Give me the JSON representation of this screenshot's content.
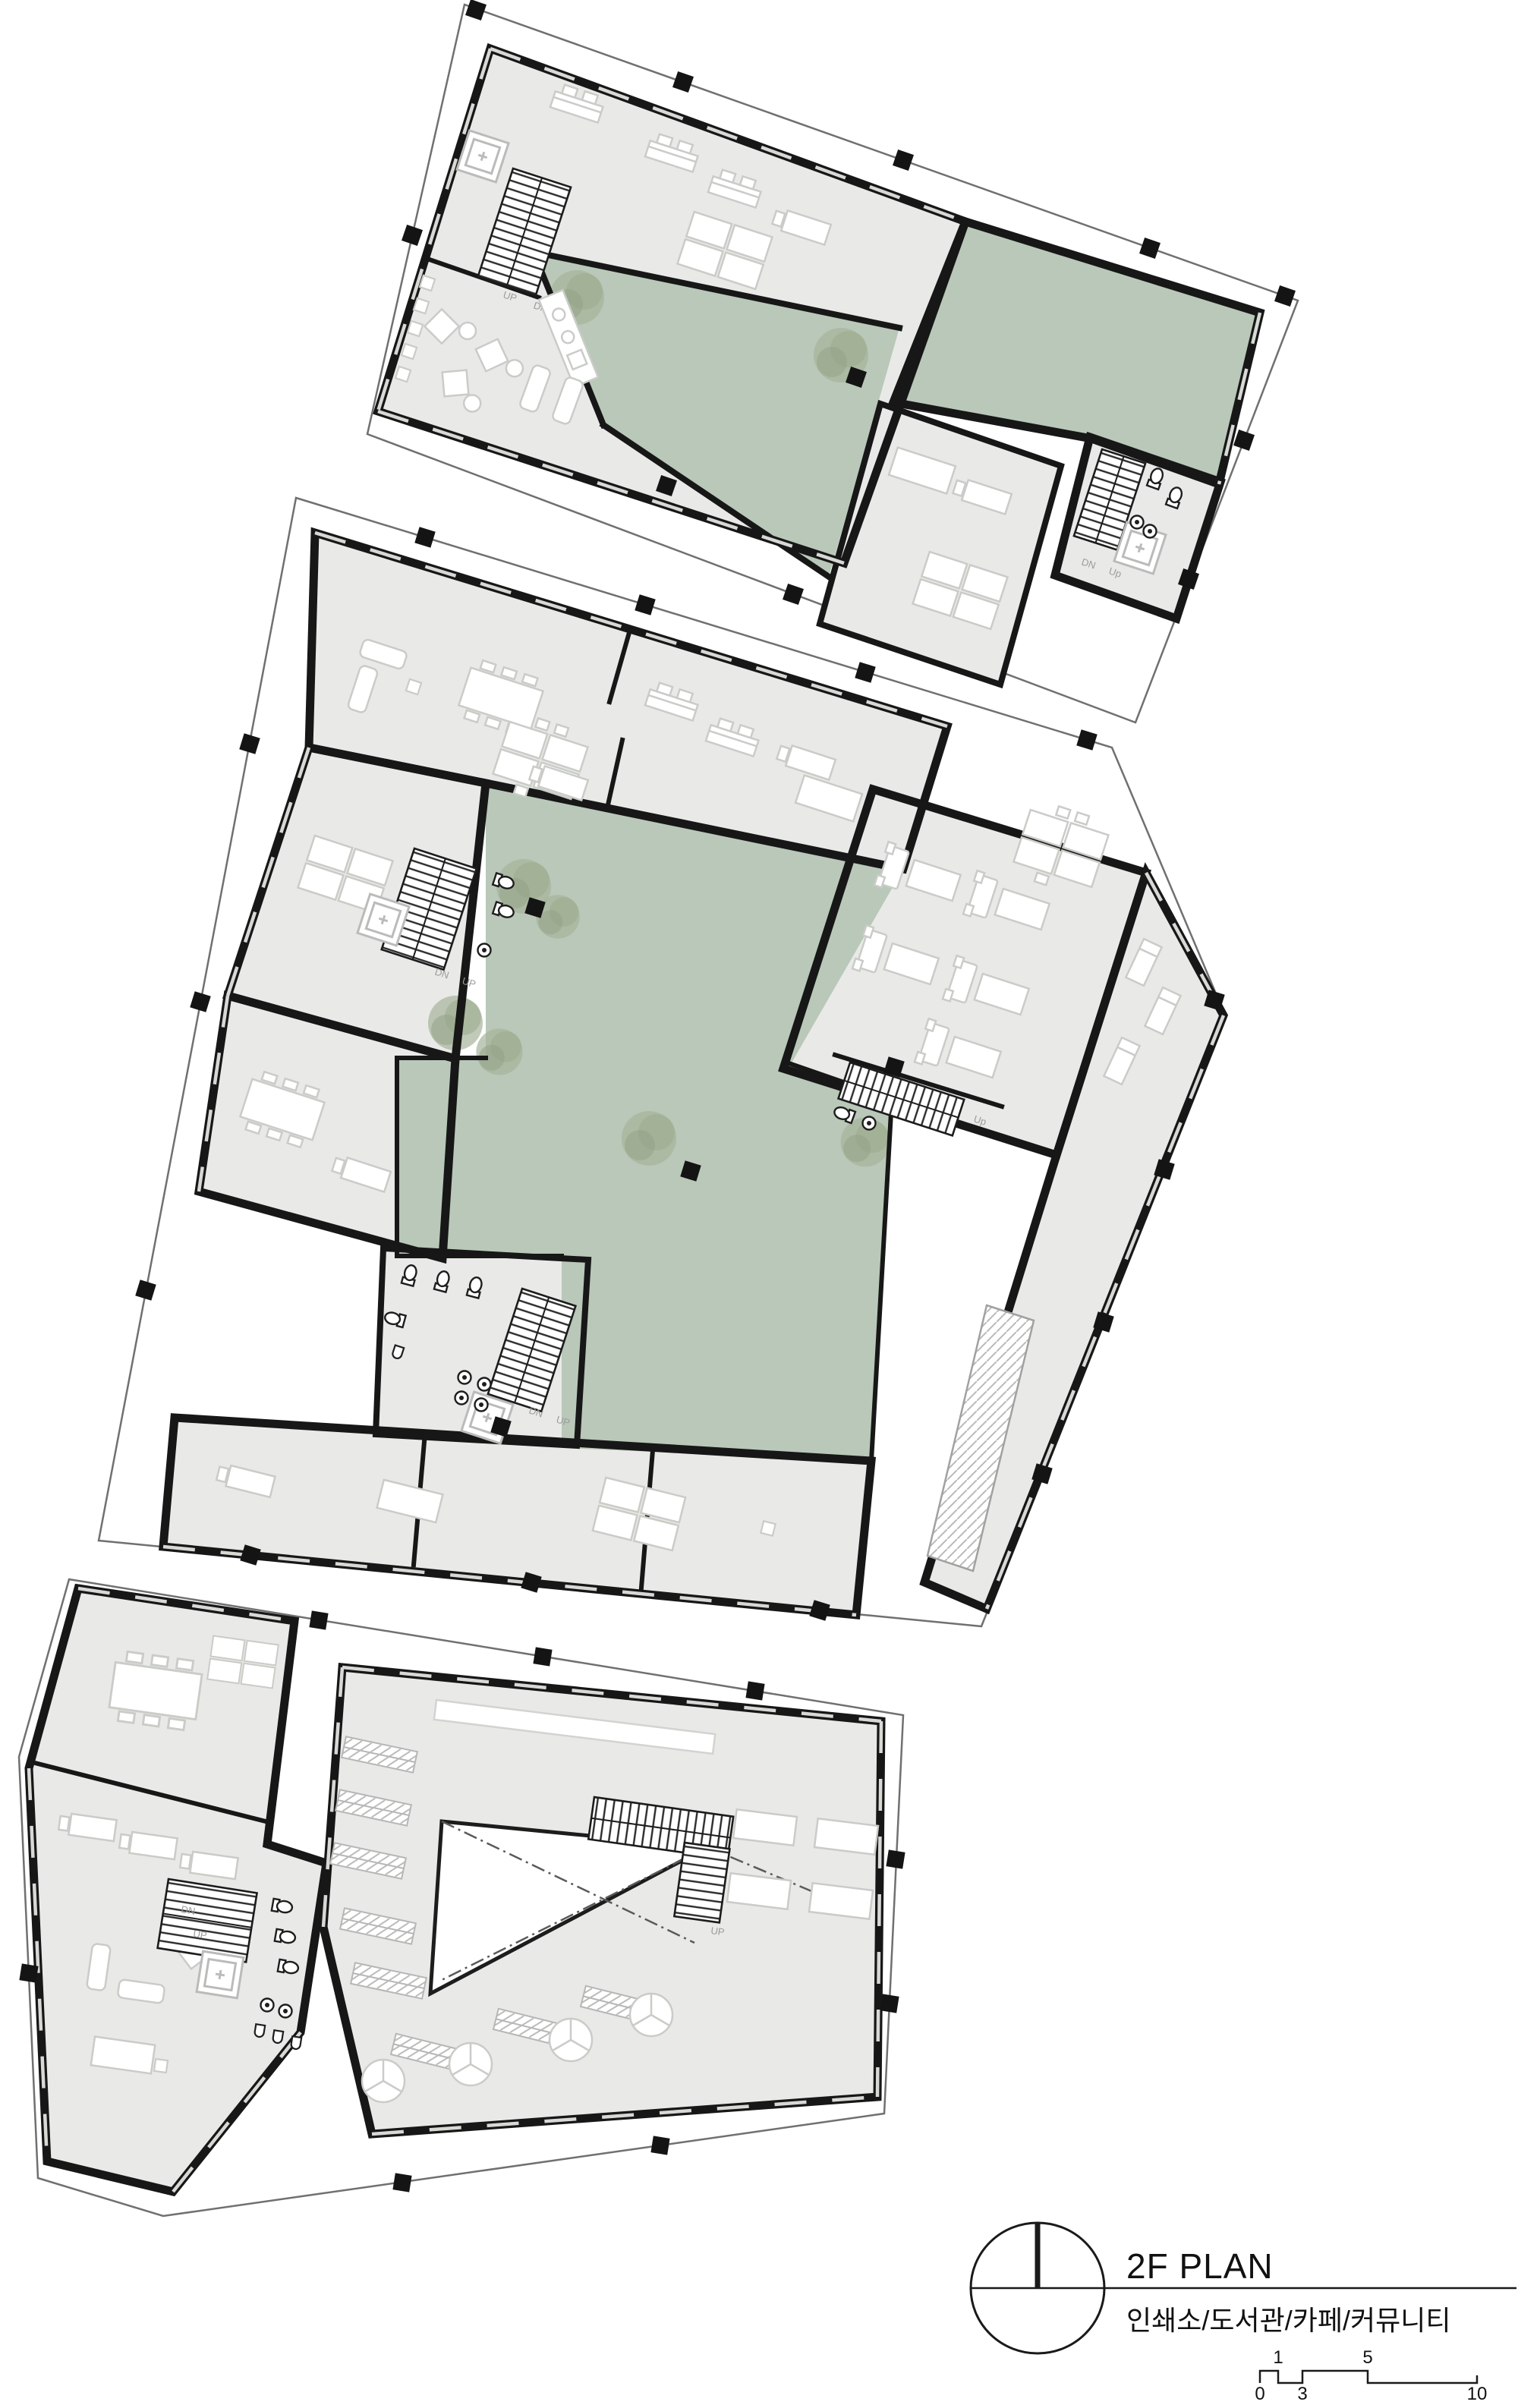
{
  "title_block": {
    "title": "2F PLAN",
    "subtitle": "인쇄소/도서관/카페/커뮤니티",
    "scale_bar": {
      "n0": "0",
      "n1": "1",
      "n3": "3",
      "n5": "5",
      "n10": "10"
    }
  },
  "stair_labels": {
    "up": "UP",
    "dn": "DN",
    "up_alt": "Up"
  },
  "colors": {
    "background": "#ffffff",
    "floor": "#e9eae7",
    "terrace_green": "#b9c8b9",
    "tree": "#a2b196",
    "wall": "#171717",
    "site_boundary": "#707070",
    "furniture_line": "#c9ccc7",
    "column": "#141414",
    "stair_text": "#9b9b9b"
  }
}
